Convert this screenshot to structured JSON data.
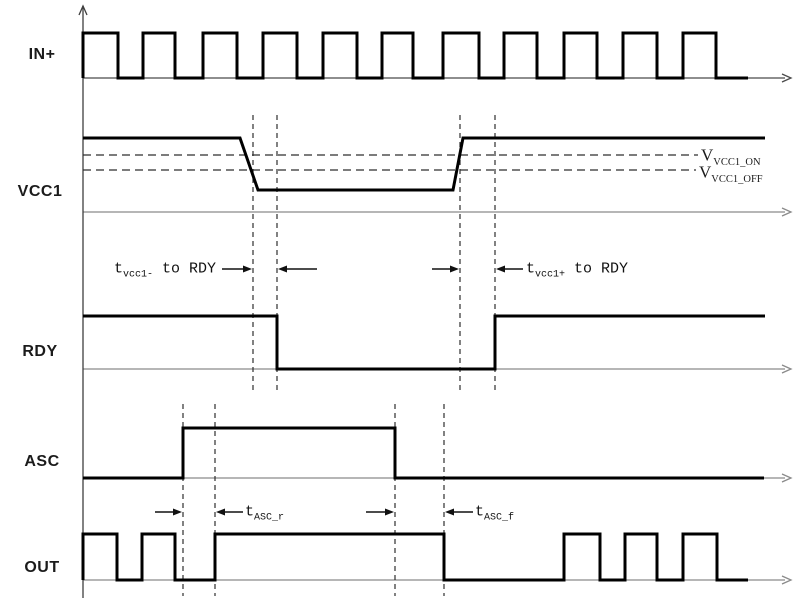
{
  "colors": {
    "background": "#ffffff",
    "signal": "#000000",
    "axis_gray": "#8a8a8a",
    "axis_dark": "#4a4a4a",
    "dashed": "#2e2e2e",
    "text": "#1b1b1b"
  },
  "axes": {
    "vertical": {
      "x": 83,
      "y_top": 6,
      "y_bottom": 598
    }
  },
  "signals": [
    {
      "id": "in-plus",
      "label": "IN+",
      "label_x": 42,
      "label_y": 55,
      "axis_y": 78,
      "axis_x1": 83,
      "axis_x2": 785,
      "axis_color": "#4a4a4a",
      "points": [
        [
          83,
          78
        ],
        [
          83,
          33
        ],
        [
          118,
          33
        ],
        [
          118,
          78
        ],
        [
          143,
          78
        ],
        [
          143,
          33
        ],
        [
          175,
          33
        ],
        [
          175,
          78
        ],
        [
          203,
          78
        ],
        [
          203,
          33
        ],
        [
          237,
          33
        ],
        [
          237,
          78
        ],
        [
          263,
          78
        ],
        [
          263,
          33
        ],
        [
          297,
          33
        ],
        [
          297,
          78
        ],
        [
          323,
          78
        ],
        [
          323,
          33
        ],
        [
          357,
          33
        ],
        [
          357,
          78
        ],
        [
          382,
          78
        ],
        [
          382,
          33
        ],
        [
          413,
          33
        ],
        [
          413,
          78
        ],
        [
          443,
          78
        ],
        [
          443,
          33
        ],
        [
          479,
          33
        ],
        [
          479,
          78
        ],
        [
          504,
          78
        ],
        [
          504,
          33
        ],
        [
          537,
          33
        ],
        [
          537,
          78
        ],
        [
          564,
          78
        ],
        [
          564,
          33
        ],
        [
          597,
          33
        ],
        [
          597,
          78
        ],
        [
          623,
          78
        ],
        [
          623,
          33
        ],
        [
          657,
          33
        ],
        [
          657,
          78
        ],
        [
          683,
          78
        ],
        [
          683,
          33
        ],
        [
          716,
          33
        ],
        [
          716,
          78
        ],
        [
          748,
          78
        ]
      ]
    },
    {
      "id": "vcc1",
      "label": "VCC1",
      "label_x": 40,
      "label_y": 192,
      "axis_y": 212,
      "axis_x1": 83,
      "axis_x2": 785,
      "axis_color": "#8a8a8a",
      "points": [
        [
          83,
          138
        ],
        [
          240,
          138
        ],
        [
          258,
          190
        ],
        [
          453,
          190
        ],
        [
          463,
          138
        ],
        [
          765,
          138
        ]
      ]
    },
    {
      "id": "rdy",
      "label": "RDY",
      "label_x": 40,
      "label_y": 352,
      "axis_y": 369,
      "axis_x1": 83,
      "axis_x2": 785,
      "axis_color": "#8a8a8a",
      "points": [
        [
          83,
          316
        ],
        [
          277,
          316
        ],
        [
          277,
          369
        ],
        [
          495,
          369
        ],
        [
          495,
          316
        ],
        [
          765,
          316
        ]
      ]
    },
    {
      "id": "asc",
      "label": "ASC",
      "label_x": 42,
      "label_y": 462,
      "axis_y": 478,
      "axis_x1": 83,
      "axis_x2": 785,
      "axis_color": "#8a8a8a",
      "points": [
        [
          83,
          478
        ],
        [
          183,
          478
        ],
        [
          183,
          428
        ],
        [
          395,
          428
        ],
        [
          395,
          478
        ],
        [
          764,
          478
        ]
      ]
    },
    {
      "id": "out",
      "label": "OUT",
      "label_x": 42,
      "label_y": 568,
      "axis_y": 580,
      "axis_x1": 83,
      "axis_x2": 785,
      "axis_color": "#8a8a8a",
      "points": [
        [
          83,
          580
        ],
        [
          83,
          534
        ],
        [
          117,
          534
        ],
        [
          117,
          580
        ],
        [
          142,
          580
        ],
        [
          142,
          534
        ],
        [
          175,
          534
        ],
        [
          175,
          580
        ],
        [
          215,
          580
        ],
        [
          215,
          534
        ],
        [
          444,
          534
        ],
        [
          444,
          580
        ],
        [
          564,
          580
        ],
        [
          564,
          534
        ],
        [
          600,
          534
        ],
        [
          600,
          580
        ],
        [
          625,
          580
        ],
        [
          625,
          534
        ],
        [
          657,
          534
        ],
        [
          657,
          580
        ],
        [
          683,
          580
        ],
        [
          683,
          534
        ],
        [
          717,
          534
        ],
        [
          717,
          580
        ],
        [
          748,
          580
        ]
      ]
    }
  ],
  "thresholds": [
    {
      "base": "V",
      "sub": "VCC1_ON",
      "y": 155,
      "x1": 83,
      "x2": 698,
      "label_x": 701,
      "label_y": 155
    },
    {
      "base": "V",
      "sub": "VCC1_OFF",
      "y": 170,
      "x1": 83,
      "x2": 696,
      "label_x": 699,
      "label_y": 172
    }
  ],
  "dashed_verticals": [
    {
      "x": 253,
      "y1": 115,
      "y2": 390
    },
    {
      "x": 277,
      "y1": 115,
      "y2": 390
    },
    {
      "x": 460,
      "y1": 115,
      "y2": 390
    },
    {
      "x": 495,
      "y1": 115,
      "y2": 390
    },
    {
      "x": 183,
      "y1": 404,
      "y2": 596
    },
    {
      "x": 215,
      "y1": 404,
      "y2": 596
    },
    {
      "x": 395,
      "y1": 404,
      "y2": 596
    },
    {
      "x": 444,
      "y1": 404,
      "y2": 596
    }
  ],
  "annotations": [
    {
      "id": "tvcc1-fall-to-rdy",
      "base": "t",
      "sub": "vcc1-",
      "rest": " to RDY",
      "label_x": 114,
      "label_y": 269,
      "arrows": [
        {
          "x1": 222,
          "x2": 252,
          "y": 269,
          "head": "right"
        },
        {
          "x1": 278,
          "x2": 317,
          "y": 269,
          "head": "left"
        }
      ]
    },
    {
      "id": "tvcc1-rise-to-rdy",
      "base": "t",
      "sub": "vcc1+",
      "rest": " to RDY",
      "label_x": 526,
      "label_y": 269,
      "arrows": [
        {
          "x1": 432,
          "x2": 459,
          "y": 269,
          "head": "right"
        },
        {
          "x1": 496,
          "x2": 523,
          "y": 269,
          "head": "left"
        }
      ]
    },
    {
      "id": "t-asc-r",
      "base": "t",
      "sub": "ASC_r",
      "rest": "",
      "label_x": 245,
      "label_y": 512,
      "arrows": [
        {
          "x1": 155,
          "x2": 182,
          "y": 512,
          "head": "right"
        },
        {
          "x1": 216,
          "x2": 243,
          "y": 512,
          "head": "left"
        },
        {
          "x1": 366,
          "x2": 394,
          "y": 512,
          "head": "right"
        }
      ]
    },
    {
      "id": "t-asc-f",
      "base": "t",
      "sub": "ASC_f",
      "rest": "",
      "label_x": 475,
      "label_y": 512,
      "arrows": [
        {
          "x1": 445,
          "x2": 473,
          "y": 512,
          "head": "left"
        }
      ]
    }
  ]
}
